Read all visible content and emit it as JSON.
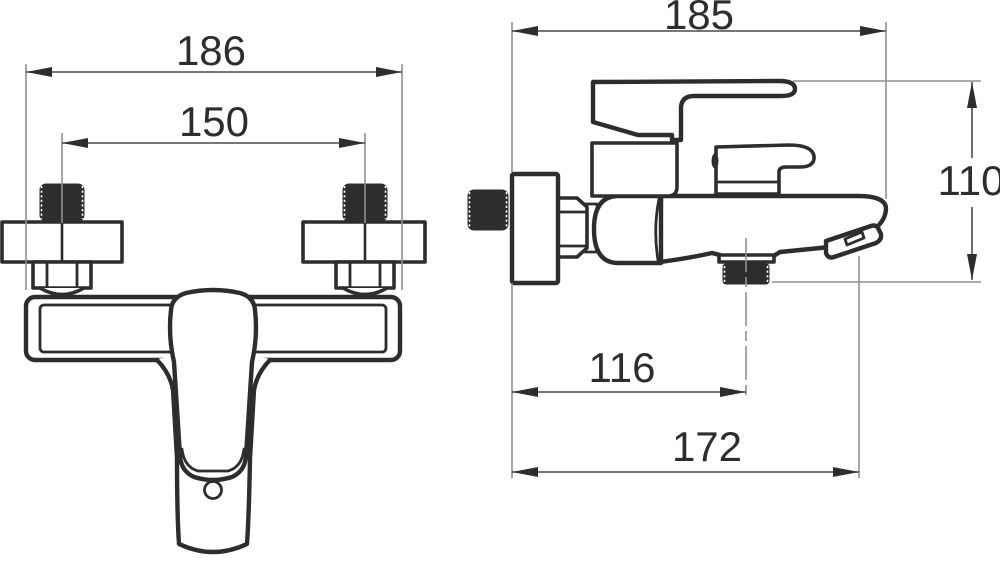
{
  "drawing": {
    "title": "wall-mounted bath mixer tap - dimensional technical drawing",
    "background_color": "#ffffff",
    "line_color": "#2d2d2d",
    "extension_line_color": "#8f8f8f",
    "views": {
      "front": {
        "name": "front view",
        "dimensions": [
          {
            "id": "overall-width",
            "label": "186"
          },
          {
            "id": "connection-centres",
            "label": "150"
          }
        ]
      },
      "side": {
        "name": "side view",
        "dimensions": [
          {
            "id": "overall-depth",
            "label": "185"
          },
          {
            "id": "overall-height",
            "label": "110"
          },
          {
            "id": "shower-outlet-offset",
            "label": "116"
          },
          {
            "id": "spout-reach",
            "label": "172"
          }
        ]
      }
    }
  }
}
